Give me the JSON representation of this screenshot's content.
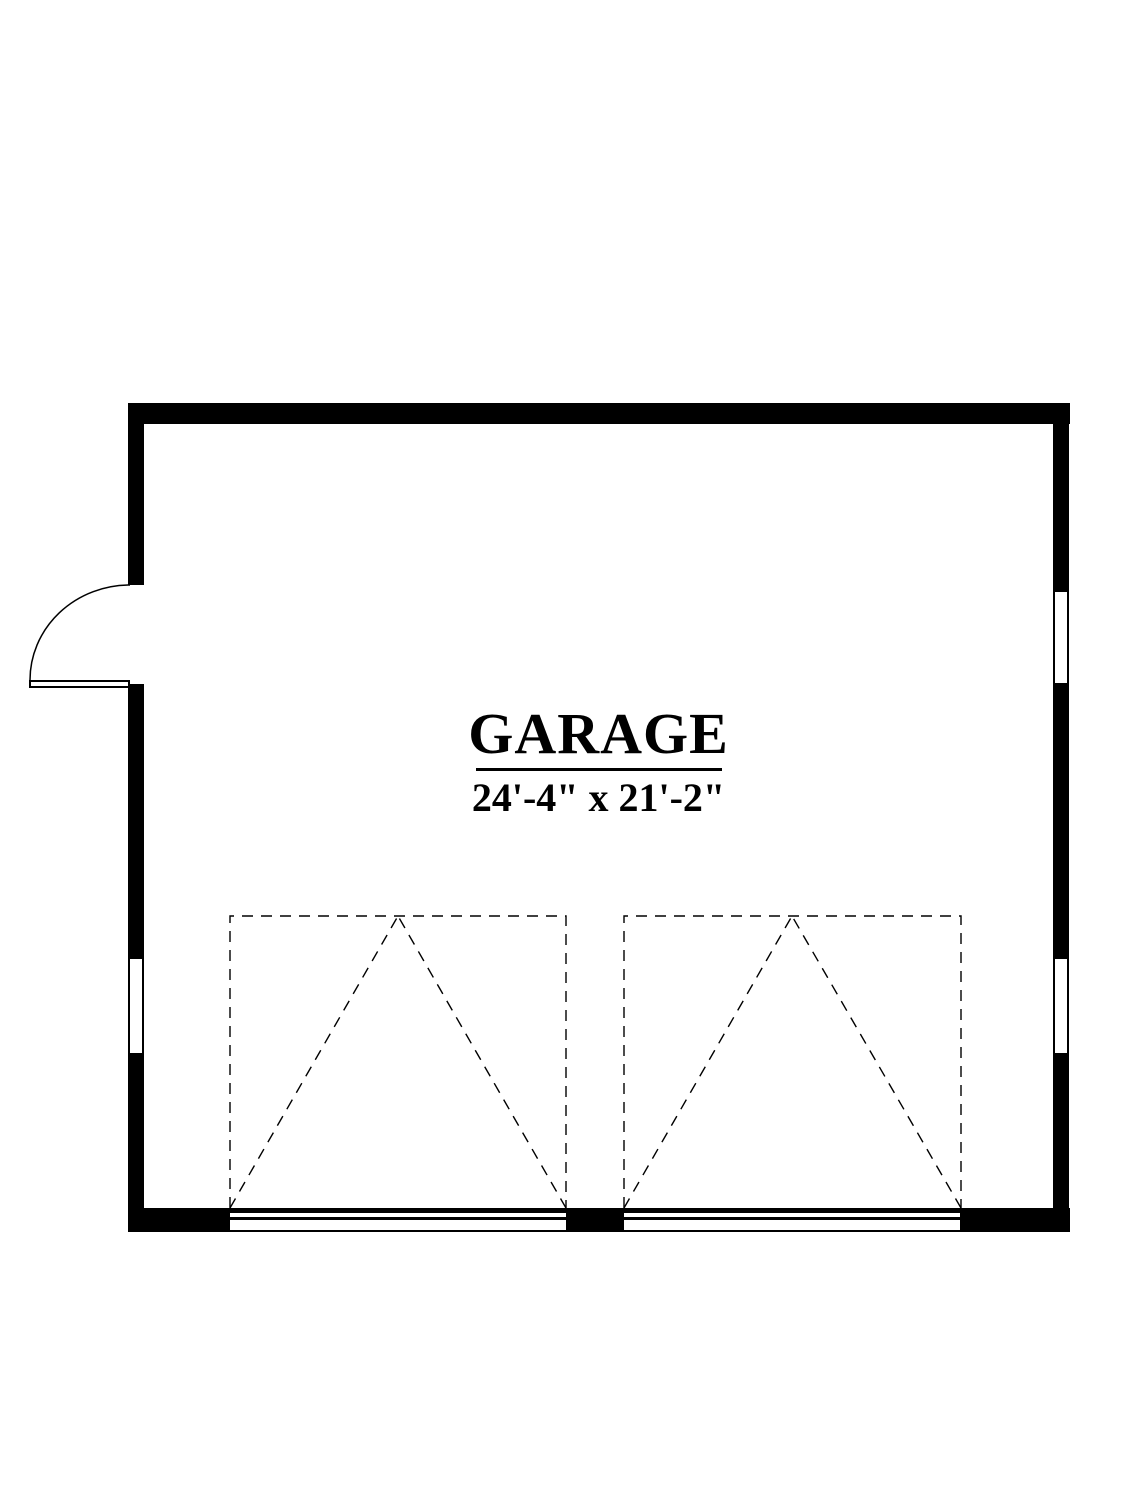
{
  "page": {
    "background_color": "#ffffff",
    "line_color": "#000000",
    "drawing_type": "floor-plan"
  },
  "room": {
    "label": "GARAGE",
    "dimensions": "24'-4\" x 21'-2\""
  },
  "features": {
    "entry_door": "hinged door with swing arc, left wall",
    "windows": [
      "left wall window",
      "right wall upper window",
      "right wall lower window"
    ],
    "garage_doors": [
      "overhead garage door 1 (dashed swing symbol)",
      "overhead garage door 2 (dashed swing symbol)"
    ]
  }
}
